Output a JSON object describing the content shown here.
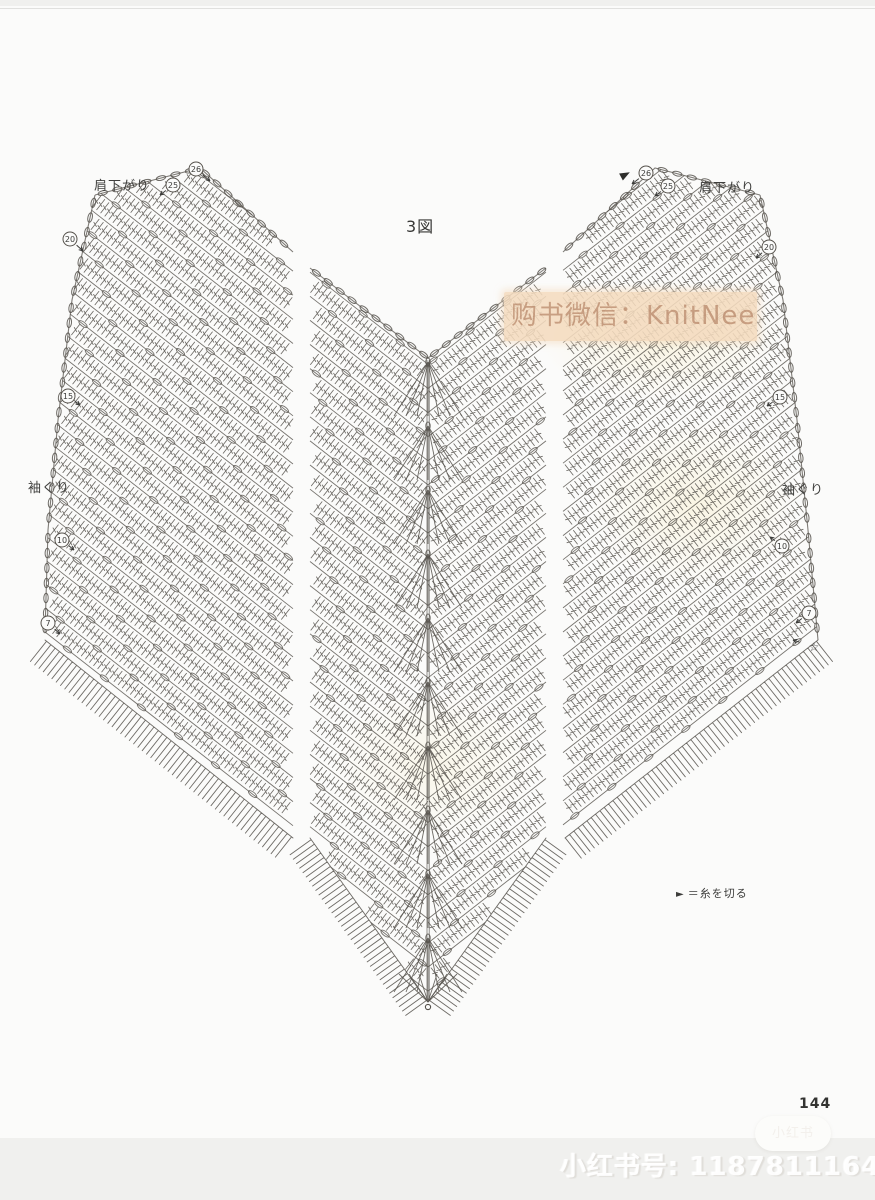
{
  "page": {
    "figure_label": "3図",
    "page_number": "144"
  },
  "labels": {
    "shoulder_left": "肩下がり",
    "shoulder_right": "肩下がり",
    "armhole_left": "袖ぐり",
    "armhole_right": "袖ぐり"
  },
  "legend": {
    "symbol": "►",
    "text": "＝糸を切る"
  },
  "watermark": {
    "band_text": "购书微信：KnitNeedle"
  },
  "footer": {
    "id_text": "小红书号: 1187811164",
    "logo_text": "小红书"
  },
  "colors": {
    "ink": "#55514b",
    "band_bg": "#f4dbc0",
    "band_text": "#ad7858",
    "paper": "#fbfbfa"
  },
  "row_markers": [
    {
      "sym": "26",
      "x": 196,
      "y": 169,
      "tx": 14,
      "ty": 12
    },
    {
      "sym": "25",
      "x": 173,
      "y": 185,
      "tx": -13,
      "ty": 10
    },
    {
      "sym": "20",
      "x": 70,
      "y": 239,
      "tx": 13,
      "ty": 12
    },
    {
      "sym": "15",
      "x": 68,
      "y": 396,
      "tx": 12,
      "ty": 9
    },
    {
      "sym": "10",
      "x": 62,
      "y": 540,
      "tx": 12,
      "ty": 10
    },
    {
      "sym": "7",
      "x": 48,
      "y": 623,
      "tx": 12,
      "ty": 11
    },
    {
      "sym": "26",
      "x": 646,
      "y": 173,
      "tx": -14,
      "ty": 11
    },
    {
      "sym": "25",
      "x": 668,
      "y": 186,
      "tx": -13,
      "ty": 10
    },
    {
      "sym": "20",
      "x": 769,
      "y": 247,
      "tx": -13,
      "ty": 11
    },
    {
      "sym": "15",
      "x": 780,
      "y": 397,
      "tx": -13,
      "ty": 9
    },
    {
      "sym": "10",
      "x": 782,
      "y": 546,
      "tx": -12,
      "ty": -9
    },
    {
      "sym": "7",
      "x": 809,
      "y": 613,
      "tx": -13,
      "ty": 10
    }
  ],
  "star_marker": {
    "sym": "☆",
    "x": 814,
    "y": 647,
    "tx": -15,
    "ty": -5
  },
  "cut_marker": {
    "x": 621,
    "y": 177
  }
}
